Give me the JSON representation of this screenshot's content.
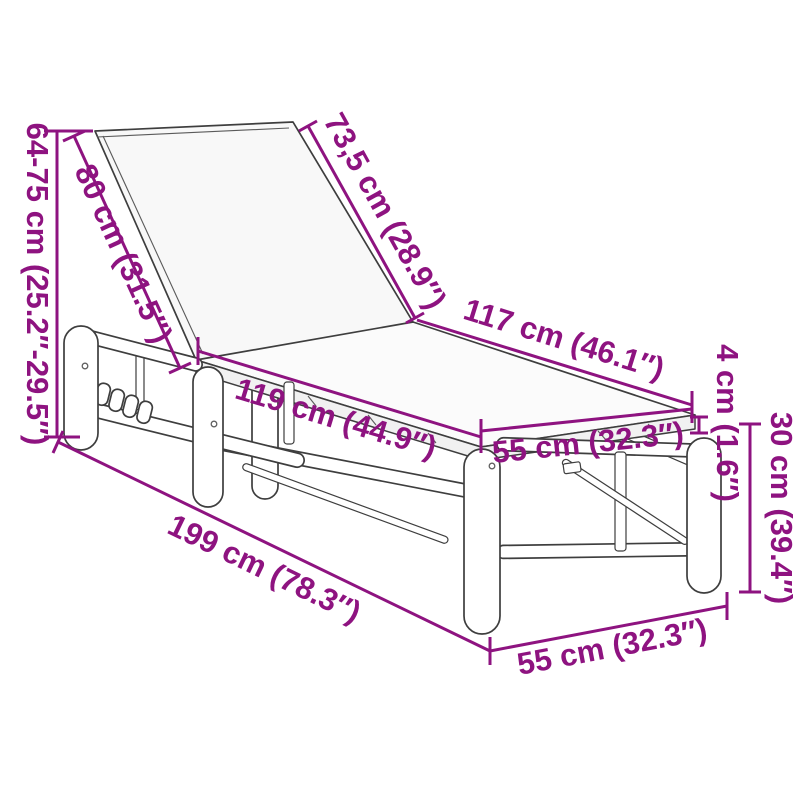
{
  "colors": {
    "accent": "#8E1380",
    "line": "#3E3E3E"
  },
  "labels": {
    "height_range": "64-75 cm (25.2″-29.5″)",
    "backrest_length": "80 cm (31.5″)",
    "backrest_top": "73,5 cm (28.9″)",
    "seat_length_top": "117 cm (46.1″)",
    "seat_length_front": "119 cm (44.9″)",
    "width_mid": "55 cm (32.3″)",
    "frame_thickness": "4 cm (1.6″)",
    "seat_height": "30 cm (39.4″)",
    "total_length": "199 cm (78.3″)",
    "width_bottom": "55 cm (32.3″)"
  }
}
